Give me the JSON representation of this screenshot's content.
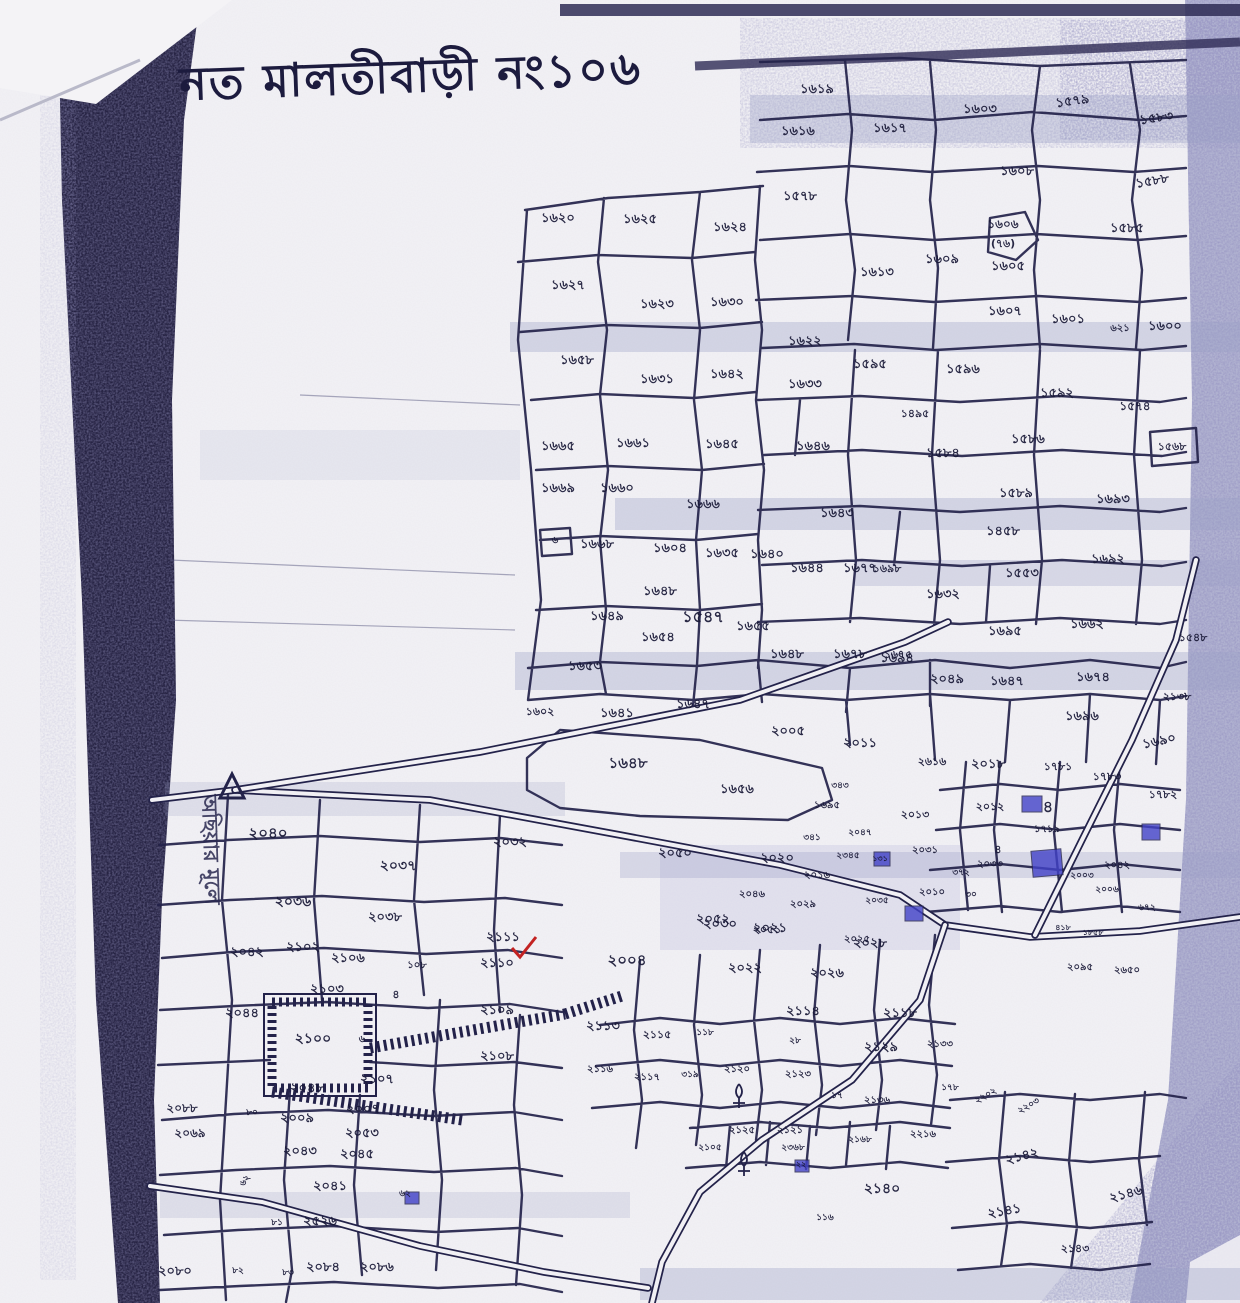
{
  "title": {
    "text": "নত মালতীবাড়ী নং১০৬"
  },
  "side_label": {
    "text": "অছিয়ার মূলে"
  },
  "map": {
    "type": "cadastral-mouza-sheet",
    "marks": {
      "red_check_plot": "২১১১",
      "circled_note": "(৭৬)"
    },
    "icons": [
      "survey-triangle-icon",
      "red-check-icon",
      "tree-icon",
      "house-block-icon",
      "hatched-compound",
      "road-double-line"
    ],
    "colors": {
      "ink": "#23224a",
      "scan_shadow": "#262343",
      "speckle": "#7d82b4",
      "structure": "#4242c8",
      "red_mark": "#c32222",
      "paper": "#f1f0f4"
    },
    "plots": [
      {
        "x": 558,
        "y": 222,
        "t": "১৬২০"
      },
      {
        "x": 640,
        "y": 223,
        "t": "১৬২৫"
      },
      {
        "x": 730,
        "y": 231,
        "t": "১৬২৪"
      },
      {
        "x": 568,
        "y": 289,
        "t": "১৬২৭"
      },
      {
        "x": 657,
        "y": 308,
        "t": "১৬২৩"
      },
      {
        "x": 727,
        "y": 306,
        "t": "১৬৩০"
      },
      {
        "x": 577,
        "y": 364,
        "t": "১৬৫৮"
      },
      {
        "x": 657,
        "y": 383,
        "t": "১৬৩১"
      },
      {
        "x": 727,
        "y": 378,
        "t": "১৬৪২"
      },
      {
        "x": 805,
        "y": 345,
        "t": "১৬২২"
      },
      {
        "x": 805,
        "y": 388,
        "t": "১৬৩৩"
      },
      {
        "x": 877,
        "y": 276,
        "t": "১৬১৩"
      },
      {
        "x": 870,
        "y": 368,
        "t": "১৫৯৫"
      },
      {
        "x": 817,
        "y": 93,
        "t": "১৬১৯"
      },
      {
        "x": 798,
        "y": 135,
        "t": "১৬১৬"
      },
      {
        "x": 890,
        "y": 132,
        "t": "১৬১৭"
      },
      {
        "x": 980,
        "y": 113,
        "t": "১৬০৩"
      },
      {
        "x": 1073,
        "y": 105,
        "t": "১৫৭৯",
        "r": -8
      },
      {
        "x": 1157,
        "y": 122,
        "t": "১৫৮৩",
        "r": -8
      },
      {
        "x": 1017,
        "y": 175,
        "t": "১৬০৮"
      },
      {
        "x": 1153,
        "y": 185,
        "t": "১৫৮৮",
        "r": -10
      },
      {
        "x": 800,
        "y": 200,
        "t": "১৫৭৮"
      },
      {
        "x": 1003,
        "y": 228,
        "t": "১৬০৬",
        "s": 12
      },
      {
        "x": 1003,
        "y": 247,
        "t": "(৭৬)",
        "s": 11
      },
      {
        "x": 1127,
        "y": 232,
        "t": "১৫৮৫"
      },
      {
        "x": 942,
        "y": 263,
        "t": "১৬০৯"
      },
      {
        "x": 1008,
        "y": 270,
        "t": "১৬০৫"
      },
      {
        "x": 1005,
        "y": 315,
        "t": "১৬০৭"
      },
      {
        "x": 1068,
        "y": 323,
        "t": "১৬০১"
      },
      {
        "x": 1120,
        "y": 331,
        "t": "৬২১",
        "s": 10
      },
      {
        "x": 1165,
        "y": 330,
        "t": "১৬০০"
      },
      {
        "x": 963,
        "y": 373,
        "t": "১৫৯৬"
      },
      {
        "x": 1057,
        "y": 397,
        "t": "১৫৯২"
      },
      {
        "x": 1135,
        "y": 410,
        "t": "১৫৭৪",
        "s": 12
      },
      {
        "x": 915,
        "y": 417,
        "t": "১৪৯৫",
        "s": 11
      },
      {
        "x": 943,
        "y": 457,
        "t": "১৫৮৪"
      },
      {
        "x": 1028,
        "y": 443,
        "t": "১৫৮৬"
      },
      {
        "x": 1172,
        "y": 450,
        "t": "১৫৬৮",
        "s": 11
      },
      {
        "x": 558,
        "y": 450,
        "t": "১৬৬৫"
      },
      {
        "x": 633,
        "y": 447,
        "t": "১৬৬১"
      },
      {
        "x": 722,
        "y": 448,
        "t": "১৬৪৫"
      },
      {
        "x": 813,
        "y": 450,
        "t": "১৬৪৬"
      },
      {
        "x": 558,
        "y": 492,
        "t": "১৬৬৯"
      },
      {
        "x": 617,
        "y": 492,
        "t": "১৬৬০"
      },
      {
        "x": 703,
        "y": 508,
        "t": "১৬৬৬"
      },
      {
        "x": 837,
        "y": 517,
        "t": "১৬৪৩"
      },
      {
        "x": 597,
        "y": 548,
        "t": "১৬৬৮"
      },
      {
        "x": 555,
        "y": 543,
        "t": "৬",
        "s": 10
      },
      {
        "x": 670,
        "y": 552,
        "t": "১৬০৪"
      },
      {
        "x": 722,
        "y": 557,
        "t": "১৬৩৫"
      },
      {
        "x": 767,
        "y": 558,
        "t": "১৬৪০"
      },
      {
        "x": 807,
        "y": 572,
        "t": "১৬৪৪"
      },
      {
        "x": 860,
        "y": 572,
        "t": "১৬৭৭"
      },
      {
        "x": 1016,
        "y": 497,
        "t": "১৫৮৯"
      },
      {
        "x": 1113,
        "y": 503,
        "t": "১৬৯৩"
      },
      {
        "x": 1003,
        "y": 535,
        "t": "১৪৫৮"
      },
      {
        "x": 1108,
        "y": 563,
        "t": "১৬৯২"
      },
      {
        "x": 887,
        "y": 572,
        "t": "১৬৯৮",
        "s": 11
      },
      {
        "x": 943,
        "y": 598,
        "t": "১৬৩২"
      },
      {
        "x": 1022,
        "y": 577,
        "t": "১৫৫৩"
      },
      {
        "x": 660,
        "y": 595,
        "t": "১৬৪৮"
      },
      {
        "x": 607,
        "y": 620,
        "t": "১৬৪৯"
      },
      {
        "x": 703,
        "y": 622,
        "t": "১৫৪৭",
        "s": 16
      },
      {
        "x": 753,
        "y": 630,
        "t": "১৬৫৫"
      },
      {
        "x": 658,
        "y": 641,
        "t": "১৬৫৪"
      },
      {
        "x": 1087,
        "y": 628,
        "t": "১৬৬২"
      },
      {
        "x": 1005,
        "y": 635,
        "t": "১৬৯৫"
      },
      {
        "x": 898,
        "y": 658,
        "t": "১৬৭৫",
        "s": 11
      },
      {
        "x": 947,
        "y": 683,
        "t": "২০৪৯"
      },
      {
        "x": 1007,
        "y": 685,
        "t": "১৬৪৭"
      },
      {
        "x": 1093,
        "y": 681,
        "t": "১৬৭৪"
      },
      {
        "x": 1193,
        "y": 641,
        "t": "১৫৪৮",
        "s": 11
      },
      {
        "x": 1177,
        "y": 700,
        "t": "২১৩৮",
        "s": 11
      },
      {
        "x": 1082,
        "y": 720,
        "t": "১৬৯৬"
      },
      {
        "x": 1160,
        "y": 745,
        "t": "১৬৯০",
        "r": -12
      },
      {
        "x": 585,
        "y": 670,
        "t": "১৬৫৩"
      },
      {
        "x": 787,
        "y": 658,
        "t": "১৬৪৮"
      },
      {
        "x": 850,
        "y": 658,
        "t": "১৬৭৮"
      },
      {
        "x": 897,
        "y": 662,
        "t": "১৬৯৪"
      },
      {
        "x": 540,
        "y": 715,
        "t": "১৬০২",
        "s": 11
      },
      {
        "x": 617,
        "y": 717,
        "t": "১৬৪১"
      },
      {
        "x": 693,
        "y": 708,
        "t": "১৬৪৭"
      },
      {
        "x": 788,
        "y": 735,
        "t": "২০০৫"
      },
      {
        "x": 860,
        "y": 747,
        "t": "২০১১"
      },
      {
        "x": 628,
        "y": 768,
        "t": "১৬৪৮",
        "s": 15
      },
      {
        "x": 737,
        "y": 793,
        "t": "১৬৫৬"
      },
      {
        "x": 932,
        "y": 765,
        "t": "২৬১৬",
        "s": 11
      },
      {
        "x": 988,
        "y": 768,
        "t": "২০১৮"
      },
      {
        "x": 1058,
        "y": 770,
        "t": "১৭৮১",
        "s": 11
      },
      {
        "x": 1107,
        "y": 780,
        "t": "১৭৮৩",
        "s": 11
      },
      {
        "x": 1163,
        "y": 798,
        "t": "১৭৮২",
        "s": 11
      },
      {
        "x": 990,
        "y": 810,
        "t": "২০১২",
        "s": 11
      },
      {
        "x": 1048,
        "y": 812,
        "t": "৪",
        "s": 16
      },
      {
        "x": 1047,
        "y": 832,
        "t": "১৭১৯",
        "s": 10
      },
      {
        "x": 915,
        "y": 818,
        "t": "২০১৩",
        "s": 11
      },
      {
        "x": 925,
        "y": 853,
        "t": "২০৩১",
        "s": 10
      },
      {
        "x": 990,
        "y": 867,
        "t": "২০৩৩",
        "s": 10
      },
      {
        "x": 998,
        "y": 853,
        "t": "৪",
        "s": 11
      },
      {
        "x": 961,
        "y": 875,
        "t": "৩৭২",
        "s": 9
      },
      {
        "x": 971,
        "y": 897,
        "t": "৩০",
        "s": 9
      },
      {
        "x": 932,
        "y": 895,
        "t": "২০১০",
        "s": 10
      },
      {
        "x": 840,
        "y": 788,
        "t": "৩৪৩",
        "s": 9
      },
      {
        "x": 827,
        "y": 808,
        "t": "১৬৯৫",
        "s": 10
      },
      {
        "x": 812,
        "y": 840,
        "t": "৩৪১",
        "s": 9
      },
      {
        "x": 848,
        "y": 858,
        "t": "২৩৪৫",
        "s": 9
      },
      {
        "x": 880,
        "y": 861,
        "t": "১৩১",
        "s": 8
      },
      {
        "x": 860,
        "y": 835,
        "t": "২০৪৭",
        "s": 9
      },
      {
        "x": 1117,
        "y": 868,
        "t": "২০৪২",
        "s": 10
      },
      {
        "x": 1082,
        "y": 878,
        "t": "২০০৩",
        "s": 9
      },
      {
        "x": 1107,
        "y": 892,
        "t": "২০০৬",
        "s": 9
      },
      {
        "x": 1147,
        "y": 910,
        "t": "৬৭২",
        "s": 9
      },
      {
        "x": 675,
        "y": 857,
        "t": "২০৫০"
      },
      {
        "x": 777,
        "y": 862,
        "t": "২০২০"
      },
      {
        "x": 817,
        "y": 878,
        "t": "২০১৬",
        "s": 10
      },
      {
        "x": 752,
        "y": 897,
        "t": "২০৪৬",
        "s": 10
      },
      {
        "x": 803,
        "y": 907,
        "t": "২০২৯",
        "s": 10
      },
      {
        "x": 877,
        "y": 903,
        "t": "২০৩৫",
        "s": 9
      },
      {
        "x": 713,
        "y": 923,
        "t": "২০৫২"
      },
      {
        "x": 767,
        "y": 933,
        "t": "২০৫১",
        "s": 11
      },
      {
        "x": 857,
        "y": 942,
        "t": "২০২৫",
        "s": 10
      },
      {
        "x": 1063,
        "y": 930,
        "t": "৪১৮",
        "s": 8
      },
      {
        "x": 1093,
        "y": 935,
        "t": "১৮৫৮",
        "s": 8
      },
      {
        "x": 1080,
        "y": 970,
        "t": "২০৯৫",
        "s": 10
      },
      {
        "x": 1127,
        "y": 973,
        "t": "২৬৫০",
        "s": 10
      },
      {
        "x": 268,
        "y": 838,
        "t": "২০৪০",
        "s": 15
      },
      {
        "x": 398,
        "y": 870,
        "t": "২০৩৭",
        "s": 14
      },
      {
        "x": 510,
        "y": 846,
        "t": "২০৩২"
      },
      {
        "x": 293,
        "y": 906,
        "t": "২০৩৬",
        "s": 14
      },
      {
        "x": 385,
        "y": 921,
        "t": "২০৩৮"
      },
      {
        "x": 503,
        "y": 941,
        "t": "২১১১"
      },
      {
        "x": 247,
        "y": 956,
        "t": "২০৪২"
      },
      {
        "x": 303,
        "y": 951,
        "t": "২১০২"
      },
      {
        "x": 348,
        "y": 962,
        "t": "২১০৬"
      },
      {
        "x": 417,
        "y": 968,
        "t": "১০৮",
        "s": 10
      },
      {
        "x": 497,
        "y": 967,
        "t": "২১১০"
      },
      {
        "x": 327,
        "y": 993,
        "t": "২১০৩"
      },
      {
        "x": 396,
        "y": 998,
        "t": "৪",
        "s": 11
      },
      {
        "x": 497,
        "y": 1014,
        "t": "২১০৯"
      },
      {
        "x": 242,
        "y": 1017,
        "t": "২০৪৪"
      },
      {
        "x": 313,
        "y": 1043,
        "t": "২১০০",
        "s": 14
      },
      {
        "x": 362,
        "y": 1042,
        "t": "৬",
        "s": 10
      },
      {
        "x": 497,
        "y": 1060,
        "t": "২১০৮"
      },
      {
        "x": 377,
        "y": 1083,
        "t": "২১০৭"
      },
      {
        "x": 307,
        "y": 1092,
        "t": "২০৪৮"
      },
      {
        "x": 182,
        "y": 1112,
        "t": "২০৮৮",
        "s": 12
      },
      {
        "x": 252,
        "y": 1115,
        "t": "৮০",
        "s": 9
      },
      {
        "x": 297,
        "y": 1122,
        "t": "২০০৯"
      },
      {
        "x": 363,
        "y": 1113,
        "t": "২০০৭"
      },
      {
        "x": 190,
        "y": 1137,
        "t": "২০৬৯",
        "s": 12
      },
      {
        "x": 362,
        "y": 1137,
        "t": "২০৫৩"
      },
      {
        "x": 300,
        "y": 1155,
        "t": "২০৪৩"
      },
      {
        "x": 357,
        "y": 1158,
        "t": "২০৪৫"
      },
      {
        "x": 330,
        "y": 1190,
        "t": "২০৪১"
      },
      {
        "x": 247,
        "y": 1182,
        "t": "৬২",
        "s": 9,
        "r": -55
      },
      {
        "x": 277,
        "y": 1225,
        "t": "৮১",
        "s": 9
      },
      {
        "x": 320,
        "y": 1225,
        "t": "২৫২৬"
      },
      {
        "x": 405,
        "y": 1196,
        "t": "৬২",
        "s": 9
      },
      {
        "x": 175,
        "y": 1275,
        "t": "২০৮০"
      },
      {
        "x": 238,
        "y": 1273,
        "t": "৮২",
        "s": 9
      },
      {
        "x": 288,
        "y": 1275,
        "t": "৮৩",
        "s": 9
      },
      {
        "x": 323,
        "y": 1271,
        "t": "২০৮৪"
      },
      {
        "x": 377,
        "y": 1271,
        "t": "২০৮৬"
      },
      {
        "x": 627,
        "y": 965,
        "t": "২০০৪",
        "s": 15
      },
      {
        "x": 720,
        "y": 928,
        "t": "২০৩০"
      },
      {
        "x": 770,
        "y": 932,
        "t": "২০২১"
      },
      {
        "x": 870,
        "y": 947,
        "t": "২০২৮"
      },
      {
        "x": 745,
        "y": 972,
        "t": "২০২২"
      },
      {
        "x": 827,
        "y": 977,
        "t": "২০২৬"
      },
      {
        "x": 803,
        "y": 1015,
        "t": "২১১৪"
      },
      {
        "x": 900,
        "y": 1017,
        "t": "২১১৮"
      },
      {
        "x": 603,
        "y": 1030,
        "t": "২১১৩"
      },
      {
        "x": 657,
        "y": 1038,
        "t": "২১১৫",
        "s": 11
      },
      {
        "x": 705,
        "y": 1035,
        "t": "১১৮",
        "s": 9
      },
      {
        "x": 795,
        "y": 1043,
        "t": "২৮",
        "s": 9
      },
      {
        "x": 881,
        "y": 1051,
        "t": "২১২৯"
      },
      {
        "x": 940,
        "y": 1047,
        "t": "২১৩৩",
        "s": 10
      },
      {
        "x": 600,
        "y": 1072,
        "t": "২১১৬",
        "s": 10
      },
      {
        "x": 647,
        "y": 1080,
        "t": "২১১৭",
        "s": 10
      },
      {
        "x": 690,
        "y": 1077,
        "t": "৩১৯",
        "s": 9
      },
      {
        "x": 737,
        "y": 1072,
        "t": "২১২০",
        "s": 10
      },
      {
        "x": 798,
        "y": 1077,
        "t": "২১২৩",
        "s": 10
      },
      {
        "x": 837,
        "y": 1098,
        "t": "১৭",
        "s": 9
      },
      {
        "x": 877,
        "y": 1103,
        "t": "২১৩৬",
        "s": 10
      },
      {
        "x": 950,
        "y": 1090,
        "t": "১৭৮",
        "s": 9
      },
      {
        "x": 710,
        "y": 1150,
        "t": "২১০৫",
        "s": 9
      },
      {
        "x": 742,
        "y": 1133,
        "t": "২১২৫",
        "s": 10
      },
      {
        "x": 790,
        "y": 1133,
        "t": "২১২১",
        "s": 10
      },
      {
        "x": 793,
        "y": 1150,
        "t": "২৩৬৮",
        "s": 9
      },
      {
        "x": 801,
        "y": 1167,
        "t": "২২",
        "s": 8
      },
      {
        "x": 860,
        "y": 1142,
        "t": "২১৬৮",
        "s": 9
      },
      {
        "x": 923,
        "y": 1137,
        "t": "২২১৬",
        "s": 10
      },
      {
        "x": 882,
        "y": 1193,
        "t": "২১৪০",
        "s": 14
      },
      {
        "x": 825,
        "y": 1220,
        "t": "১১৬",
        "s": 9
      },
      {
        "x": 987,
        "y": 1098,
        "t": "২২০২",
        "s": 9,
        "r": -30
      },
      {
        "x": 1030,
        "y": 1108,
        "t": "২২০৩",
        "s": 9,
        "r": -30
      },
      {
        "x": 1023,
        "y": 1160,
        "t": "২১৪২",
        "s": 13,
        "r": -15
      },
      {
        "x": 1127,
        "y": 1198,
        "t": "২১৪৬",
        "s": 13,
        "r": -15
      },
      {
        "x": 1005,
        "y": 1215,
        "t": "২১৪১",
        "s": 13,
        "r": -10
      },
      {
        "x": 1075,
        "y": 1252,
        "t": "২১৪৩",
        "s": 11
      }
    ]
  }
}
